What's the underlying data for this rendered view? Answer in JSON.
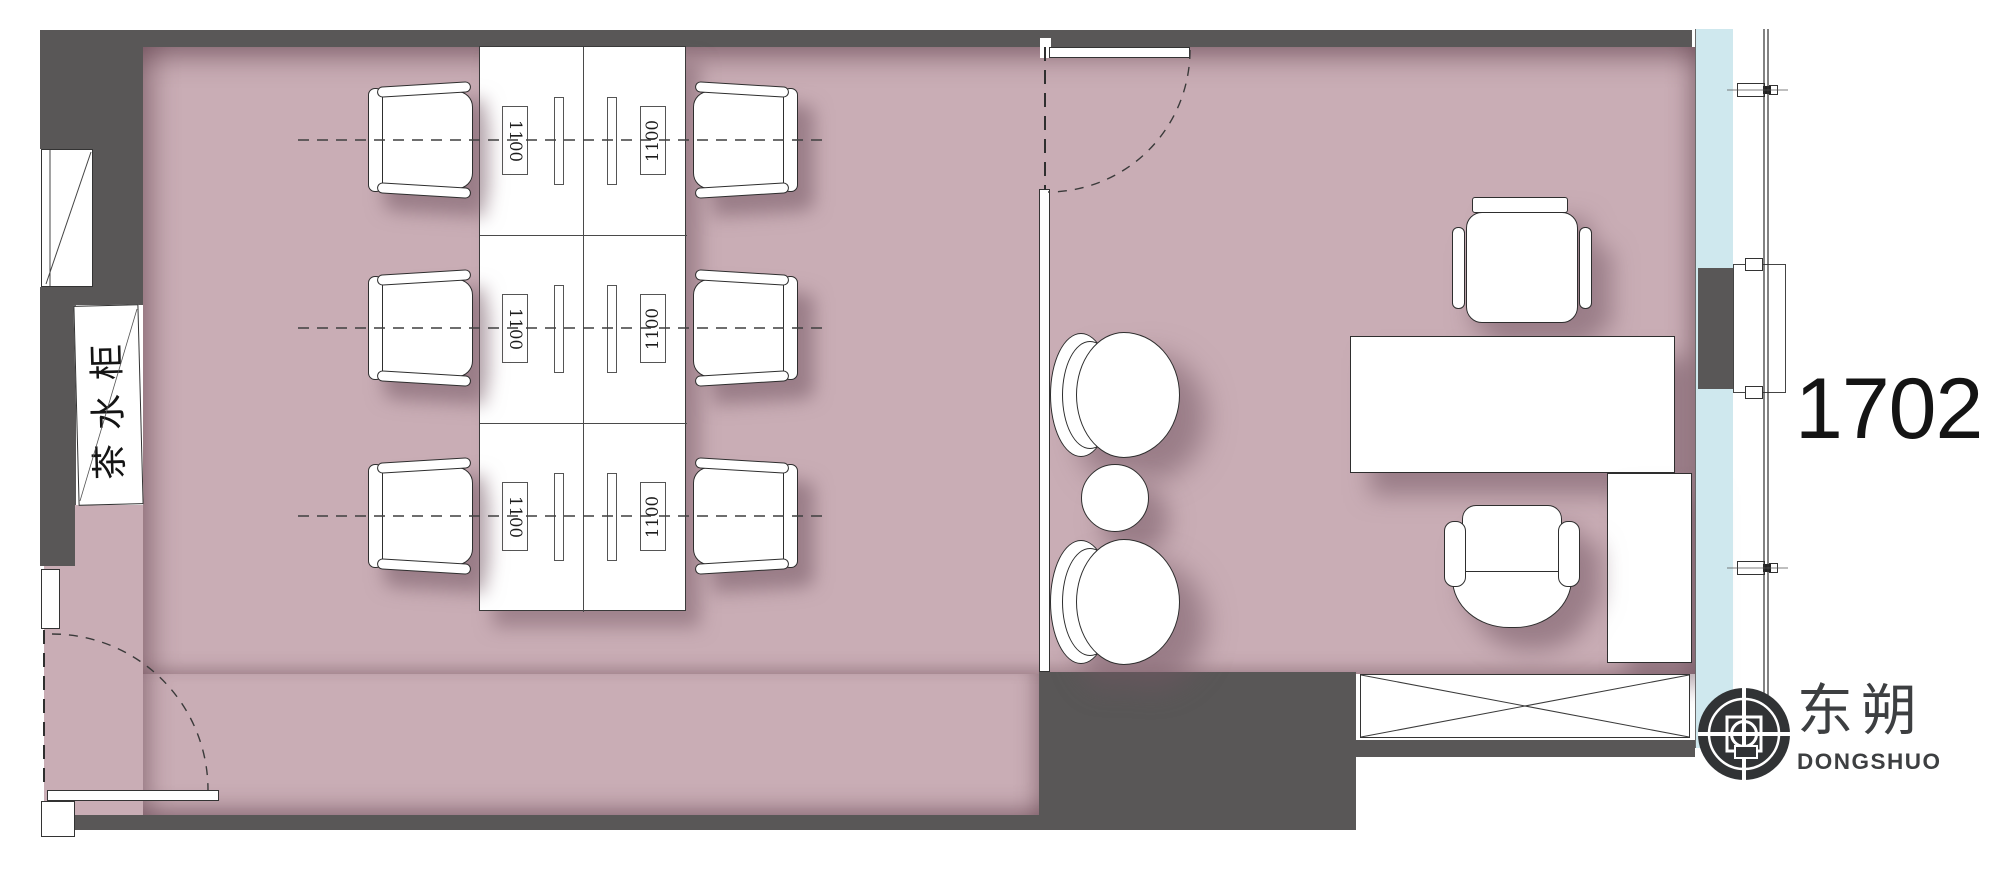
{
  "unit_number": "1702",
  "labels": {
    "tea_cabinet": "茶水柜",
    "desk_size": "1100"
  },
  "logo": {
    "cn": "东朔",
    "en": "DONGSHUO"
  },
  "colors": {
    "wall": "#595757",
    "floor": "#c9adb5",
    "glass_band": "#cfe8ee",
    "linework": "#3a3a3a",
    "logo_mark": "#313335",
    "text": "#141414"
  }
}
